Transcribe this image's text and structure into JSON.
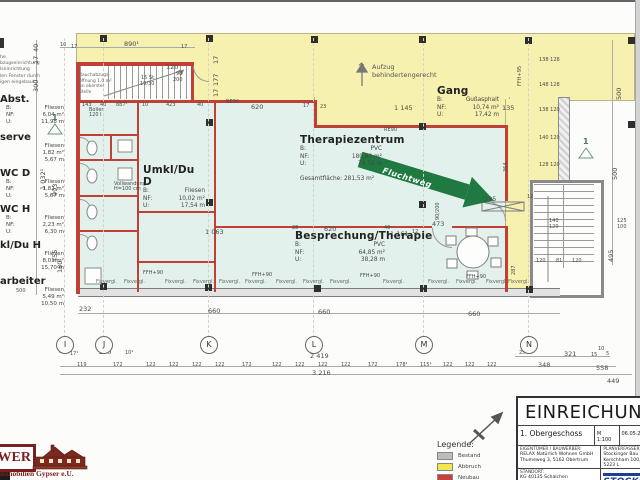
{
  "sheet_title": "EINREICHUNG",
  "note_topleft": {
    "lines": [
      "he",
      "bzugseinrichtung",
      "lseinrichtung",
      "len Fenster durch",
      "igen eingebaut"
    ]
  },
  "stair_note": [
    "Rauchabzugs-",
    "öffnung 1,0 m²",
    "an oberster Stelle"
  ],
  "margin_rooms": [
    {
      "y": 94,
      "name": "Abst.",
      "rows": [
        [
          "B:",
          "Fliesen"
        ],
        [
          "NF:",
          "6,04 m²"
        ],
        [
          "U:",
          "11,98 m"
        ]
      ]
    },
    {
      "y": 132,
      "name": "serve",
      "rows": [
        [
          "",
          "Fliesen"
        ],
        [
          "",
          "1,82 m²"
        ],
        [
          "",
          "5,67 m"
        ]
      ]
    },
    {
      "y": 168,
      "name": "WC D",
      "rows": [
        [
          "B:",
          "Fliesen"
        ],
        [
          "NF:",
          "1,82 m²"
        ],
        [
          "U:",
          "5,67 m"
        ]
      ]
    },
    {
      "y": 204,
      "name": "WC H",
      "rows": [
        [
          "B:",
          "Fliesen"
        ],
        [
          "NF:",
          "2,23 m²"
        ],
        [
          "U:",
          "6,30 m"
        ]
      ]
    },
    {
      "y": 240,
      "name": "kl/Du H",
      "rows": [
        [
          "",
          "Fliesen"
        ],
        [
          "",
          "8,01 m²"
        ],
        [
          "",
          "15,70 m"
        ]
      ]
    },
    {
      "y": 276,
      "name": "arbeiter",
      "rows": [
        [
          "",
          "Fliesen"
        ],
        [
          "",
          "5,49 m²"
        ],
        [
          "",
          "10,50 m"
        ]
      ]
    }
  ],
  "rooms": [
    {
      "x": 143,
      "y": 164,
      "w": 62,
      "name": "Umkl/Du D",
      "rows": [
        [
          "B:",
          "Fliesen"
        ],
        [
          "NF:",
          "10,02 m²"
        ],
        [
          "U:",
          "17,54 m"
        ]
      ]
    },
    {
      "x": 300,
      "y": 134,
      "w": 82,
      "name": "Therapiezentrum",
      "rows": [
        [
          "B:",
          "PVC"
        ],
        [
          "NF:",
          "180,82 m²"
        ],
        [
          "U:",
          "74,72 m"
        ]
      ],
      "extra": "Gesamtfläche: 281,53 m²"
    },
    {
      "x": 295,
      "y": 230,
      "w": 90,
      "name": "Besprechung/Therapie",
      "rows": [
        [
          "B:",
          "PVC"
        ],
        [
          "NF:",
          "64,85 m²"
        ],
        [
          "U:",
          "38,28 m"
        ]
      ]
    },
    {
      "x": 437,
      "y": 85,
      "w": 62,
      "name": "Gang",
      "rows": [
        [
          "B:",
          "Gußasphalt"
        ],
        [
          "NF:",
          "10,74 m²"
        ],
        [
          "U:",
          "17,42 m"
        ]
      ]
    }
  ],
  "aufzug": {
    "arrow": "↑",
    "lines": [
      "Aufzug",
      "behindertengerecht"
    ]
  },
  "fluchtweg": "Fluchtweg",
  "section_marker": "1",
  "grid": {
    "bubbles": [
      {
        "l": "I",
        "x": 64
      },
      {
        "l": "J",
        "x": 103
      },
      {
        "l": "K",
        "x": 208
      },
      {
        "l": "L",
        "x": 313
      },
      {
        "l": "M",
        "x": 423
      },
      {
        "l": "N",
        "x": 528
      }
    ]
  },
  "legend": {
    "title": "Legende:",
    "items": [
      {
        "label": "Bestand",
        "color": "#bdbdbd"
      },
      {
        "label": "Abbruch",
        "color": "#f2e84e"
      },
      {
        "label": "Neubau",
        "color": "#c8403a"
      }
    ]
  },
  "title_block": {
    "title": "EINREICHUNG",
    "floor": "1. Obergeschoss",
    "scale": "M 1:100",
    "date": "06.05.20",
    "owner_label": "Eigentümer / Bauwerber:",
    "owner": [
      "RELAX Natürlich Wohnen GmbH",
      "Thumeweg 3, 5162 Obertrum"
    ],
    "planner_label": "Planverfasser:",
    "planner": [
      "Stockinger Bau",
      "Kerschham 100, 5223 L"
    ],
    "site_label": "Standort:",
    "site": [
      "KG 40135 Schalchen",
      "EZ 768, Grst. Nr. 250"
    ],
    "address_label": "Adresse:",
    "address": [
      "Lamitz 29"
    ],
    "brand": "STOCKINGER",
    "brand_sub": "Bau GmbH"
  },
  "logo": {
    "big": "WER",
    "sub": "mmobilien Gypser e.U."
  },
  "colors": {
    "abbruch_fill": "#f6f1ae",
    "neubau_wall": "#c04038",
    "bestand": "#bdbdbd",
    "room_fill": "#e3f1ec",
    "fluchtweg_green": "#1e7a40",
    "brand_blue": "#1d3f8f",
    "logo_maroon": "#7a1f1f"
  },
  "placed_labels": [
    [
      "10",
      60,
      43,
      "t"
    ],
    [
      "17",
      71,
      45,
      "t"
    ],
    [
      "890¹",
      124,
      41,
      "d"
    ],
    [
      "17",
      181,
      45,
      "t"
    ],
    [
      "120",
      166,
      64,
      "d"
    ],
    [
      "90",
      176,
      72,
      "t"
    ],
    [
      "200",
      173,
      78,
      "t"
    ],
    [
      "15 St",
      141,
      76,
      "t"
    ],
    [
      "19/30",
      140,
      82,
      "t"
    ],
    [
      "143",
      82,
      103,
      "t"
    ],
    [
      "40",
      100,
      103,
      "t"
    ],
    [
      "887¹",
      116,
      103,
      "t"
    ],
    [
      "10",
      142,
      103,
      "t"
    ],
    [
      "423",
      166,
      103,
      "t"
    ],
    [
      "40",
      197,
      103,
      "t"
    ],
    [
      "620",
      251,
      104,
      "d"
    ],
    [
      "17",
      303,
      104,
      "t"
    ],
    [
      "23",
      320,
      105,
      "t"
    ],
    [
      "1 145",
      394,
      105,
      "d"
    ],
    [
      "135",
      502,
      105,
      "d"
    ],
    [
      "RE90",
      226,
      100,
      "t"
    ],
    [
      "RE90",
      384,
      128,
      "t"
    ],
    [
      "40",
      33,
      52,
      "dv"
    ],
    [
      "17",
      33,
      64,
      "dv"
    ],
    [
      "300",
      33,
      92,
      "dv"
    ],
    [
      "1 032¹",
      40,
      190,
      "dv"
    ],
    [
      "993",
      52,
      196,
      "dv"
    ],
    [
      "455",
      52,
      262,
      "dv"
    ],
    [
      "180",
      57,
      273,
      "dv"
    ],
    [
      "500",
      16,
      289,
      "t"
    ],
    [
      "17",
      213,
      64,
      "dv"
    ],
    [
      "177",
      213,
      86,
      "dv"
    ],
    [
      "17",
      213,
      97,
      "dv"
    ],
    [
      "500",
      616,
      100,
      "dv"
    ],
    [
      "500",
      612,
      180,
      "dv"
    ],
    [
      "495",
      608,
      262,
      "dv"
    ],
    [
      "FFH+95",
      518,
      86,
      "tv"
    ],
    [
      "138 128",
      539,
      58,
      "t"
    ],
    [
      "148 128",
      539,
      83,
      "t"
    ],
    [
      "138 120",
      539,
      108,
      "t"
    ],
    [
      "140 120",
      539,
      136,
      "t"
    ],
    [
      "128 120",
      539,
      163,
      "t"
    ],
    [
      "364",
      504,
      172,
      "tv"
    ],
    [
      "287",
      512,
      275,
      "tv"
    ],
    [
      "1 063",
      205,
      229,
      "d"
    ],
    [
      "28",
      292,
      226,
      "t"
    ],
    [
      "620",
      324,
      226,
      "d"
    ],
    [
      "40",
      384,
      226,
      "t"
    ],
    [
      "1 161",
      390,
      231,
      "d"
    ],
    [
      "473",
      432,
      221,
      "d"
    ],
    [
      "12",
      412,
      230,
      "t"
    ],
    [
      "235",
      484,
      196,
      "d"
    ],
    [
      "90/200",
      436,
      220,
      "tv"
    ],
    [
      "12",
      527,
      195,
      "t"
    ],
    [
      "120",
      536,
      259,
      "t"
    ],
    [
      "81",
      556,
      259,
      "t"
    ],
    [
      "120",
      572,
      259,
      "t"
    ],
    [
      "140",
      549,
      219,
      "t"
    ],
    [
      "120",
      549,
      225,
      "t"
    ],
    [
      "125",
      617,
      219,
      "t"
    ],
    [
      "100",
      617,
      225,
      "t"
    ],
    [
      "FFH+90",
      143,
      271,
      "t"
    ],
    [
      "FFH+90",
      252,
      273,
      "t"
    ],
    [
      "FFH+90",
      360,
      274,
      "t"
    ],
    [
      "FFH+90",
      466,
      275,
      "t"
    ],
    [
      "Fixvergl.",
      96,
      280,
      "i"
    ],
    [
      "Fixvergl.",
      124,
      280,
      "i"
    ],
    [
      "Fixvergl.",
      165,
      280,
      "i"
    ],
    [
      "Fixvergl.",
      193,
      280,
      "i"
    ],
    [
      "Fixvergl.",
      219,
      280,
      "i"
    ],
    [
      "Fixvergl.",
      245,
      280,
      "i"
    ],
    [
      "Fixvergl.",
      276,
      280,
      "i"
    ],
    [
      "Fixvergl.",
      303,
      280,
      "i"
    ],
    [
      "Fixvergl.",
      330,
      280,
      "i"
    ],
    [
      "Fixvergl.",
      383,
      280,
      "i"
    ],
    [
      "Fixvergl.",
      428,
      280,
      "i"
    ],
    [
      "Fixvergl.",
      456,
      280,
      "i"
    ],
    [
      "Fixvergl.",
      486,
      280,
      "i"
    ],
    [
      "Fixvergl.",
      508,
      280,
      "i"
    ],
    [
      "232",
      79,
      306,
      "d"
    ],
    [
      "660",
      208,
      308,
      "d"
    ],
    [
      "660",
      318,
      309,
      "d"
    ],
    [
      "660",
      468,
      311,
      "d"
    ],
    [
      "10",
      59,
      350,
      "t"
    ],
    [
      "17¹",
      70,
      352,
      "t"
    ],
    [
      "270",
      99,
      349,
      "d"
    ],
    [
      "10¹",
      125,
      351,
      "t"
    ],
    [
      "119",
      77,
      363,
      "t"
    ],
    [
      "172",
      113,
      363,
      "t"
    ],
    [
      "122",
      146,
      363,
      "t"
    ],
    [
      "122",
      169,
      363,
      "t"
    ],
    [
      "122",
      192,
      363,
      "t"
    ],
    [
      "122",
      215,
      363,
      "t"
    ],
    [
      "172",
      242,
      363,
      "t"
    ],
    [
      "122",
      272,
      363,
      "t"
    ],
    [
      "122",
      295,
      363,
      "t"
    ],
    [
      "122",
      318,
      363,
      "t"
    ],
    [
      "122",
      341,
      363,
      "t"
    ],
    [
      "172",
      368,
      363,
      "t"
    ],
    [
      "178¹",
      396,
      363,
      "t"
    ],
    [
      "115¹",
      420,
      363,
      "t"
    ],
    [
      "122",
      443,
      363,
      "t"
    ],
    [
      "122",
      465,
      363,
      "t"
    ],
    [
      "122",
      487,
      363,
      "t"
    ],
    [
      "348",
      538,
      362,
      "d"
    ],
    [
      "25",
      519,
      351,
      "t"
    ],
    [
      "321",
      564,
      351,
      "d"
    ],
    [
      "15",
      591,
      353,
      "t"
    ],
    [
      "10",
      598,
      347,
      "t"
    ],
    [
      "5",
      606,
      352,
      "t"
    ],
    [
      "2 419",
      310,
      353,
      "d"
    ],
    [
      "3 216",
      312,
      370,
      "d"
    ],
    [
      "558",
      596,
      365,
      "d"
    ],
    [
      "449",
      607,
      378,
      "d"
    ],
    [
      "Boiler",
      89,
      108,
      "t"
    ],
    [
      "120 l",
      89,
      113,
      "t"
    ],
    [
      "Vollwandung",
      114,
      182,
      "t"
    ],
    [
      "H=100 cm",
      114,
      187,
      "t"
    ]
  ]
}
